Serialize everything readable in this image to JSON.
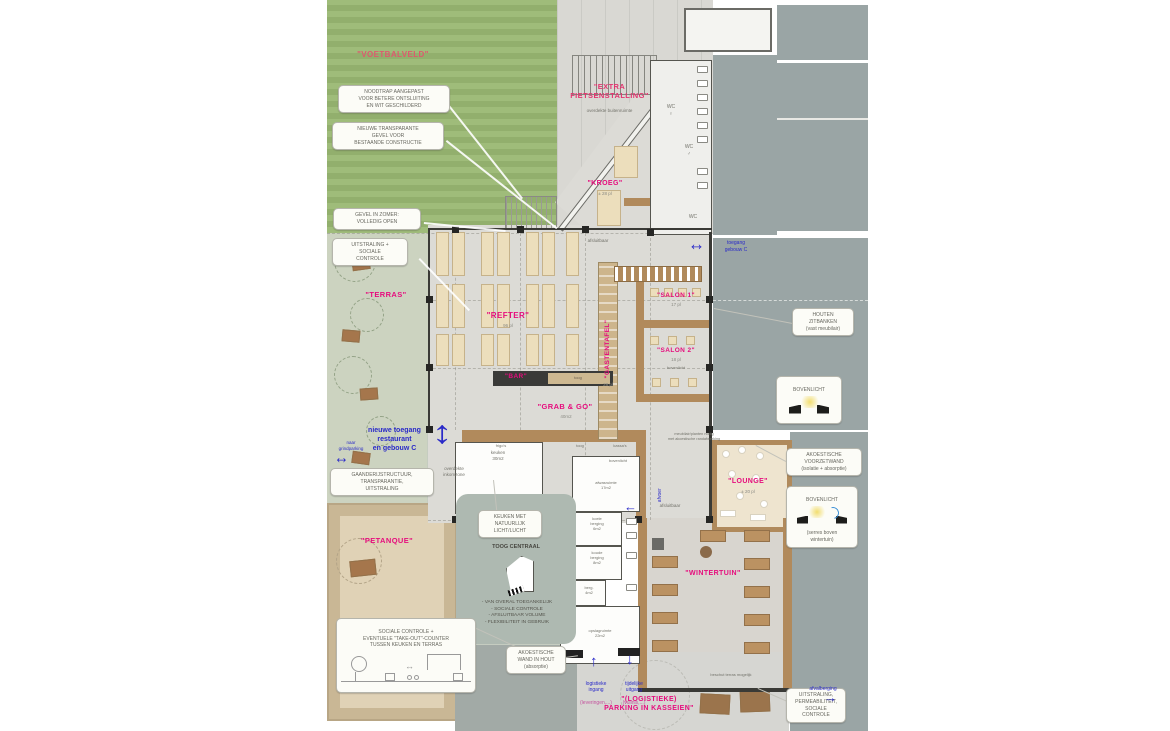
{
  "colors": {
    "magenta": "#e60c7d",
    "soft_red": "#dd5a6e",
    "blue": "#2a2ac8",
    "grass": "#9ab873",
    "concrete": "#d9d8d3",
    "existing_gray": "#9aa5a5",
    "sand": "#e0d2b6",
    "wood": "#b18a5c"
  },
  "labels": {
    "voetbalveld": "\"VOETBALVELD\"",
    "fietsenstalling": "\"EXTRA\nFIETSENSTALLING\"",
    "fietsenstalling_sub": "overdekte buitenruimte",
    "kroeg": "\"KROEG\"",
    "kroeg_cap": "± 28 pl",
    "refter": "\"REFTER\"",
    "refter_cap": "96 pl",
    "gastentafel": "\"GASTENTAFEL\"",
    "gastentafel_cap": "28 pl",
    "salon1": "\"SALON 1\"",
    "salon1_cap": "17 pl",
    "salon2": "\"SALON 2\"",
    "salon2_cap": "18 pl",
    "salon2_note": "bovenlicht",
    "bar": "\"BAR\"",
    "bar_note": "toog",
    "grabgo": "\"GRAB & GO\"",
    "grabgo_cap": "40m2",
    "terras": "\"TERRAS\"",
    "lounge": "\"LOUNGE\"",
    "lounge_cap": "± 20 pl",
    "wintertuin": "\"WINTERTUIN\"",
    "petanque": "\"PETANQUE\"",
    "parking": "\"(LOGISTIEKE)\nPARKING IN KASSEIEN\""
  },
  "callouts": {
    "noodtrap": "NOODTRAP AANGEPAST\nVOOR BETERE ONTSLUITING\nEN WIT GESCHILDERD",
    "gevel": "NIEUWE TRANSPARANTE\nGEVEL VOOR\nBESTAANDE CONSTRUCTIE",
    "zomer": "GEVEL IN ZOMER:\nVOLLEDIG OPEN",
    "uitstraling": "UITSTRALING +\nSOCIALE\nCONTROLE",
    "gaanderij": "GAANDERIJSTRUCTUUR,\nTRANSPARANTIE,\nUITSTRALING",
    "takeout": "SOCIALE CONTROLE +\nEVENTUELE \"TAKE-OUT\"-COUNTER\nTUSSEN KEUKEN EN TERRAS",
    "keuken_licht": "KEUKEN MET\nNATUURLIJK\nLICHT/LUCHT",
    "toog_centraal": "TOOG CENTRAAL",
    "toog_lijst": "- VAN OVERAL TOEGANKELIJK\n- SOCIALE CONTROLE\n- AFSLUITBAAR VOLUME\n- FLEXIBILITEIT IN GEBRUIK",
    "akoestische_wand": "AKOESTISCHE\nWAND IN HOUT\n(absorptie)",
    "zitbanken": "HOUTEN\nZITBANKEN\n(vast meubilair)",
    "bovenlicht1": "BOVENLICHT",
    "voorzetwand": "AKOESTISCHE\nVOORZETWAND\n(isolatie + absorptie)",
    "bovenlicht2": "BOVENLICHT",
    "bovenlicht2_sub": "(serres boven\nwintertuin)",
    "uitstraling2": "UITSTRALING,\nPERMEABILITEIT,\nSOCIALE\nCONTROLE"
  },
  "blue": {
    "toegang_c": "toegang\ngebouw C",
    "nieuwe_toegang": "nieuwe toegang\nrestaurant\nen gebouw C",
    "grindparking": "naar\ngrindparking",
    "afvoer": "afvoer",
    "logistiek_in": "logistieke\ningang",
    "logistiek_in_sub": "(leveringen,...)",
    "tijdelijk_uit": "tijdelijke\nuitgang",
    "tijdelijk_uit_sub": "(vuilnis,...)",
    "afvalberging": "afvalberging"
  },
  "rooms": {
    "wc_f": "WC\n♀",
    "wc_m": "WC\n♂",
    "wc": "WC",
    "keuken": "keuken\n30m2",
    "afwas": "afwasruimte\n17m2",
    "koel": "koele\nberging\n6m2",
    "koud": "koude\nberging\n8m2",
    "berg": "berg.\n4m2",
    "opslag": "opslagruimte\n22m2",
    "frigos": "frigo's",
    "toog": "toog",
    "kassas": "kassa's",
    "bovenlicht_counter": "bovenlicht",
    "afsluitbaar1": "afsluitbaar",
    "afsluitbaar2": "afsluitbaar",
    "inkomzone": "overdekte\ninkomzone",
    "beschut": "beschut terras mogelijk",
    "akoest_note": "meubilair/planten nodig\nmet akoestische randafwerking"
  }
}
